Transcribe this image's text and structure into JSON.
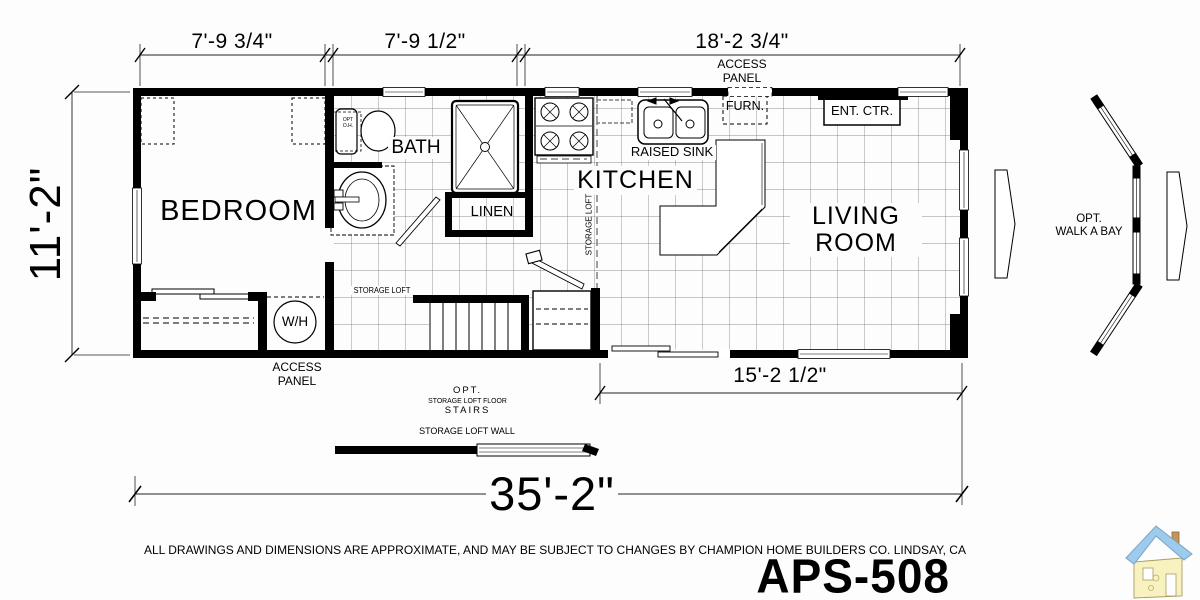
{
  "model": {
    "name": "APS-508"
  },
  "disclaimer": "ALL  DRAWINGS AND DIMENSIONS ARE APPROXIMATE, AND MAY BE SUBJECT TO CHANGES BY CHAMPION HOME BUILDERS CO. LINDSAY, CA",
  "dimensions": {
    "top_left": "7'-9 3/4\"",
    "top_middle": "7'-9 1/2\"",
    "top_right": "18'-2 3/4\"",
    "left_height": "11'-2\"",
    "bottom_living": "15'-2 1/2\"",
    "overall_length": "35'-2\""
  },
  "rooms": {
    "bedroom": "BEDROOM",
    "bath": "BATH",
    "kitchen": "KITCHEN",
    "living_room": "LIVING ROOM",
    "linen": "LINEN"
  },
  "labels": {
    "access_panel_top": "ACCESS PANEL",
    "access_panel_bottom": "ACCESS PANEL",
    "raised_sink": "RAISED SINK",
    "furnace": "FURN.",
    "entertainment_center": "ENT. CTR.",
    "water_heater": "W/H",
    "opt_overhead_line1": "OPT",
    "opt_overhead_line2": "O.H.",
    "storage_loft_left": "STORAGE LOFT",
    "storage_loft_right_vertical": "STORAGE LOFT",
    "opt_stairs_line1": "OPT.",
    "opt_stairs_line2": "STORAGE LOFT FLOOR",
    "opt_stairs_line3": "STAIRS",
    "storage_loft_wall": "STORAGE LOFT WALL",
    "walk_a_bay_line1": "OPT.",
    "walk_a_bay_line2": "WALK A BAY"
  },
  "colors": {
    "ink": "#000000",
    "paper": "#fdfdfd",
    "grid_line": "#6b6b6b",
    "logo_roof": "#9ccbed",
    "logo_wall": "#f8f2c0",
    "logo_chimney": "#c2975a"
  }
}
